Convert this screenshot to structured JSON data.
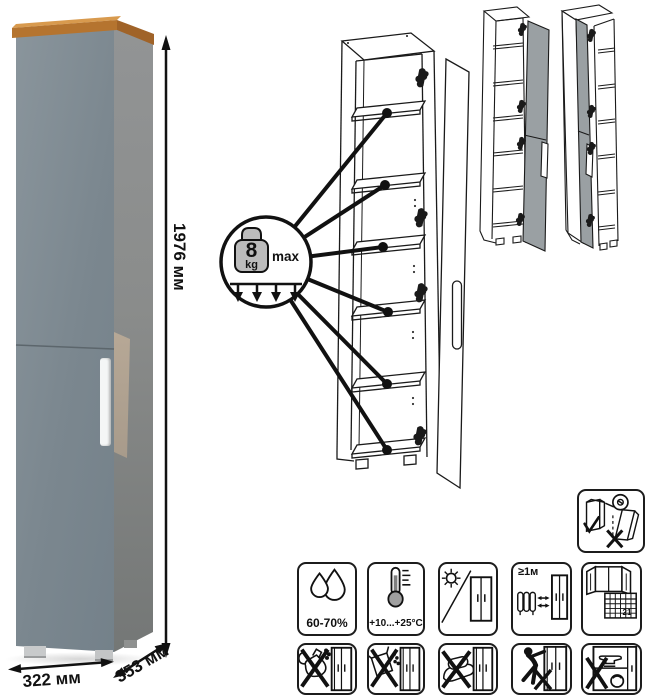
{
  "dimensions": {
    "height": "1976 мм",
    "width": "322 мм",
    "depth": "353 мм"
  },
  "shelf_load_badge": {
    "value": "8",
    "unit": "kg",
    "qualifier": "max"
  },
  "care_icons": {
    "row1": [
      {
        "name": "humidity-icon",
        "label": "60-70%"
      },
      {
        "name": "temperature-icon",
        "label": "+10...+25°С"
      },
      {
        "name": "no-direct-sunlight-icon",
        "label": ""
      },
      {
        "name": "distance-from-heat-icon",
        "label": "≥1м"
      },
      {
        "name": "ventilation-calendar-icon",
        "calendar_day": "21"
      }
    ],
    "row2": [
      {
        "name": "no-pouring-liquid-icon"
      },
      {
        "name": "no-abrasive-powder-icon"
      },
      {
        "name": "no-wet-sponge-icon"
      },
      {
        "name": "no-dragging-icon"
      },
      {
        "name": "no-overload-icon"
      }
    ]
  },
  "safety": {
    "wall_anchor_icon": "anchor-to-wall-icon"
  },
  "drawings": {
    "main": "open-cabinet-with-shelf-load-callout",
    "variants": [
      "door-hinged-right",
      "door-hinged-left"
    ]
  },
  "colors": {
    "door": "#7e8a91",
    "side_panel": "#85888a",
    "top_wood": "#bf7b3c",
    "handle": "#f4f6f6",
    "drawing_door_gray": "#9aa0a3",
    "line": "#1a1a1a"
  }
}
